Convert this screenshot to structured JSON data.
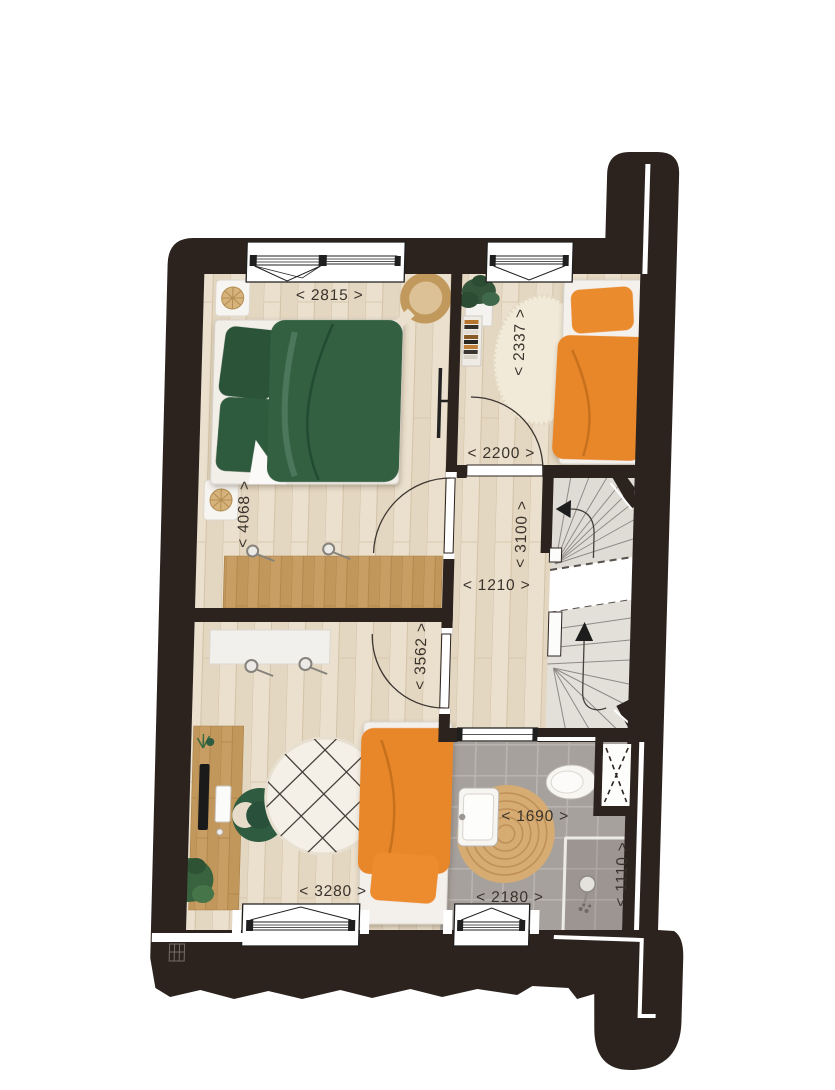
{
  "plan": {
    "name": "first-floor-plan",
    "dimensions": {
      "bedroom1_width": "< 2815 >",
      "bedroom1_depth": "< 4068 >",
      "bedroom2_depth": "< 2337 >",
      "bedroom2_width": "< 2200 >",
      "landing_depth": "< 3100 >",
      "landing_width": "< 1210 >",
      "bedroom3_depth": "< 3562 >",
      "bedroom3_width": "< 3280 >",
      "bathroom_inner_width": "< 1690 >",
      "bathroom_width": "< 2180 >",
      "bathroom_depth": "< 1110 >"
    },
    "colors": {
      "wall": "#2c231f",
      "floor_wood": "#ebe0cd",
      "bathroom_tile": "#a7a19d",
      "bed_green": "#306141",
      "bed_orange": "#e8872b",
      "desk_wood": "#c89e65",
      "stair_tread": "#dfdcd6",
      "label_text": "#39322c"
    },
    "icons": {
      "stairs_up_arrow": "triangle-up",
      "stairs_down_arrow": "triangle-left",
      "shaft_symbol": "dashed-x",
      "radiator_symbol": "crossed-box",
      "shower": "shower-head",
      "plants": "plant"
    }
  }
}
